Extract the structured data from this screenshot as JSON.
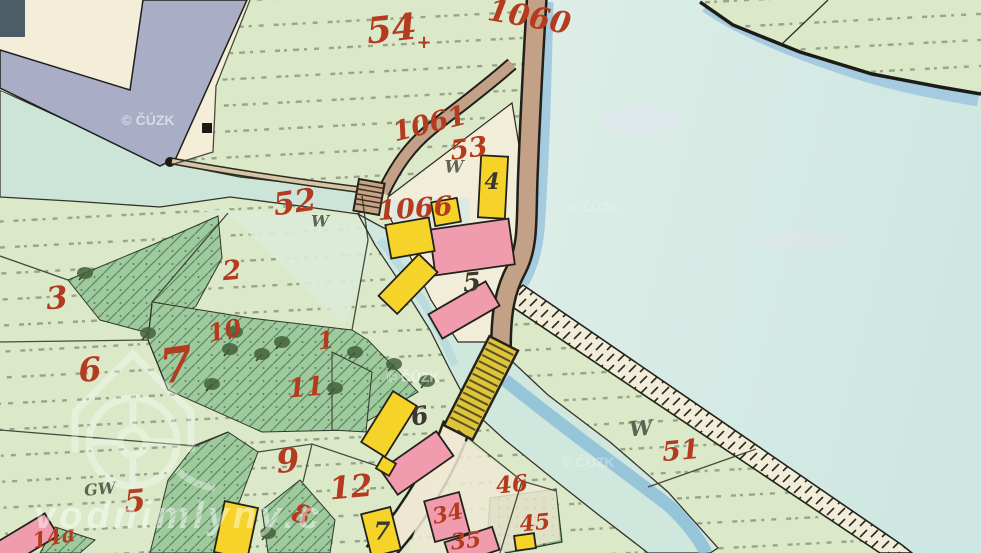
{
  "map": {
    "colors": {
      "label_red": "#b43a20",
      "label_black": "#3b382e",
      "label_grey": "#5d6454",
      "field_green": "#dbe9c9",
      "meadow_green": "#9fca9d",
      "water_pond": "#d7ebe3",
      "water_river": "#cde4d8",
      "water_dark": "#8fc0d8",
      "road_tan": "#c2a186",
      "building_wood": "#f5d329",
      "building_stone": "#f09cae",
      "sheet_cream": "#f4eed8",
      "sheet_grey": "#a9aec6"
    },
    "labels": [
      {
        "t": "54",
        "x": 392,
        "y": 32,
        "s": 36,
        "r": -6,
        "c": "red"
      },
      {
        "t": "+",
        "x": 424,
        "y": 43,
        "s": 18,
        "r": 0,
        "c": "red"
      },
      {
        "t": "1060",
        "x": 529,
        "y": 19,
        "s": 30,
        "r": 10,
        "c": "red"
      },
      {
        "t": "1061",
        "x": 430,
        "y": 125,
        "s": 27,
        "r": -14,
        "c": "red"
      },
      {
        "t": "53",
        "x": 469,
        "y": 150,
        "s": 27,
        "r": -8,
        "c": "red"
      },
      {
        "t": "52",
        "x": 295,
        "y": 204,
        "s": 31,
        "r": -8,
        "c": "red"
      },
      {
        "t": "1066",
        "x": 415,
        "y": 210,
        "s": 27,
        "r": -4,
        "c": "red"
      },
      {
        "t": "2",
        "x": 232,
        "y": 272,
        "s": 27,
        "r": -5,
        "c": "red"
      },
      {
        "t": "3",
        "x": 57,
        "y": 300,
        "s": 31,
        "r": -5,
        "c": "red"
      },
      {
        "t": "10",
        "x": 225,
        "y": 332,
        "s": 24,
        "r": -12,
        "c": "red"
      },
      {
        "t": "1",
        "x": 326,
        "y": 342,
        "s": 24,
        "r": -8,
        "c": "red"
      },
      {
        "t": "11",
        "x": 306,
        "y": 389,
        "s": 26,
        "r": -5,
        "c": "red"
      },
      {
        "t": "7",
        "x": 177,
        "y": 369,
        "s": 48,
        "r": -8,
        "c": "red"
      },
      {
        "t": "6",
        "x": 90,
        "y": 372,
        "s": 33,
        "r": -5,
        "c": "red"
      },
      {
        "t": "9",
        "x": 288,
        "y": 463,
        "s": 33,
        "r": -5,
        "c": "red"
      },
      {
        "t": "8",
        "x": 301,
        "y": 516,
        "s": 26,
        "r": 18,
        "c": "red"
      },
      {
        "t": "12",
        "x": 351,
        "y": 489,
        "s": 31,
        "r": -5,
        "c": "red"
      },
      {
        "t": "5",
        "x": 135,
        "y": 503,
        "s": 31,
        "r": -5,
        "c": "red"
      },
      {
        "t": "51",
        "x": 681,
        "y": 452,
        "s": 27,
        "r": -5,
        "c": "red"
      },
      {
        "t": "46",
        "x": 512,
        "y": 486,
        "s": 23,
        "r": -6,
        "c": "red"
      },
      {
        "t": "45",
        "x": 535,
        "y": 524,
        "s": 22,
        "r": -6,
        "c": "red"
      },
      {
        "t": "34",
        "x": 448,
        "y": 515,
        "s": 22,
        "r": -12,
        "c": "red"
      },
      {
        "t": "35",
        "x": 466,
        "y": 542,
        "s": 22,
        "r": -6,
        "c": "red"
      },
      {
        "t": "14a",
        "x": 54,
        "y": 539,
        "s": 21,
        "r": -10,
        "c": "red"
      },
      {
        "t": "4",
        "x": 492,
        "y": 183,
        "s": 22,
        "r": 0,
        "c": "black"
      },
      {
        "t": "5",
        "x": 472,
        "y": 284,
        "s": 26,
        "r": -5,
        "c": "black"
      },
      {
        "t": "6",
        "x": 420,
        "y": 418,
        "s": 25,
        "r": -10,
        "c": "black"
      },
      {
        "t": "7",
        "x": 382,
        "y": 533,
        "s": 24,
        "r": 0,
        "c": "black"
      },
      {
        "t": "W",
        "x": 454,
        "y": 168,
        "s": 17,
        "r": 0,
        "c": "grey"
      },
      {
        "t": "W",
        "x": 320,
        "y": 222,
        "s": 16,
        "r": 0,
        "c": "grey"
      },
      {
        "t": "W",
        "x": 641,
        "y": 430,
        "s": 21,
        "r": -5,
        "c": "grey"
      },
      {
        "t": "GW",
        "x": 100,
        "y": 490,
        "s": 16,
        "r": -5,
        "c": "grey"
      }
    ],
    "watermarks": [
      {
        "t": "© ČÚZK",
        "x": 148,
        "y": 125,
        "s": 14,
        "o": 0.55
      },
      {
        "t": "© ČÚZK",
        "x": 413,
        "y": 382,
        "s": 14,
        "o": 0.5
      },
      {
        "t": "© ČÚZK",
        "x": 588,
        "y": 467,
        "s": 14,
        "o": 0.3
      },
      {
        "t": "© ČÚZK",
        "x": 594,
        "y": 212,
        "s": 13,
        "o": 0.22
      }
    ],
    "site_watermark": {
      "t": "vodnimlyny.c",
      "x": 34,
      "y": 528,
      "s": 38
    },
    "buildings": [
      {
        "cx": 493,
        "cy": 187,
        "w": 27,
        "h": 62,
        "r": 3,
        "type": "wood"
      },
      {
        "cx": 446,
        "cy": 212,
        "w": 26,
        "h": 24,
        "r": -10,
        "type": "wood"
      },
      {
        "cx": 472,
        "cy": 247,
        "w": 80,
        "h": 46,
        "r": -8,
        "type": "stone"
      },
      {
        "cx": 410,
        "cy": 238,
        "w": 44,
        "h": 34,
        "r": -10,
        "type": "wood"
      },
      {
        "cx": 408,
        "cy": 284,
        "w": 26,
        "h": 58,
        "r": 44,
        "type": "wood"
      },
      {
        "cx": 464,
        "cy": 310,
        "w": 28,
        "h": 66,
        "r": 60,
        "type": "stone"
      },
      {
        "cx": 389,
        "cy": 424,
        "w": 28,
        "h": 60,
        "r": 32,
        "type": "wood"
      },
      {
        "cx": 417,
        "cy": 463,
        "w": 30,
        "h": 68,
        "r": 55,
        "type": "stone"
      },
      {
        "cx": 386,
        "cy": 466,
        "w": 15,
        "h": 14,
        "r": 30,
        "type": "wood"
      },
      {
        "cx": 381,
        "cy": 532,
        "w": 30,
        "h": 44,
        "r": -14,
        "type": "wood"
      },
      {
        "cx": 447,
        "cy": 517,
        "w": 36,
        "h": 42,
        "r": -15,
        "type": "stone"
      },
      {
        "cx": 472,
        "cy": 546,
        "w": 50,
        "h": 24,
        "r": -18,
        "type": "stone"
      },
      {
        "cx": 525,
        "cy": 542,
        "w": 20,
        "h": 15,
        "r": -8,
        "type": "wood"
      },
      {
        "cx": 236,
        "cy": 530,
        "w": 34,
        "h": 52,
        "r": 12,
        "type": "wood"
      },
      {
        "cx": 24,
        "cy": 541,
        "w": 26,
        "h": 64,
        "r": 59,
        "type": "stone"
      }
    ],
    "trees": [
      [
        85,
        273
      ],
      [
        148,
        333
      ],
      [
        235,
        332
      ],
      [
        212,
        384
      ],
      [
        282,
        342
      ],
      [
        335,
        388
      ],
      [
        355,
        352
      ],
      [
        394,
        364
      ],
      [
        427,
        381
      ],
      [
        268,
        533
      ],
      [
        230,
        349
      ],
      [
        262,
        354
      ]
    ]
  }
}
